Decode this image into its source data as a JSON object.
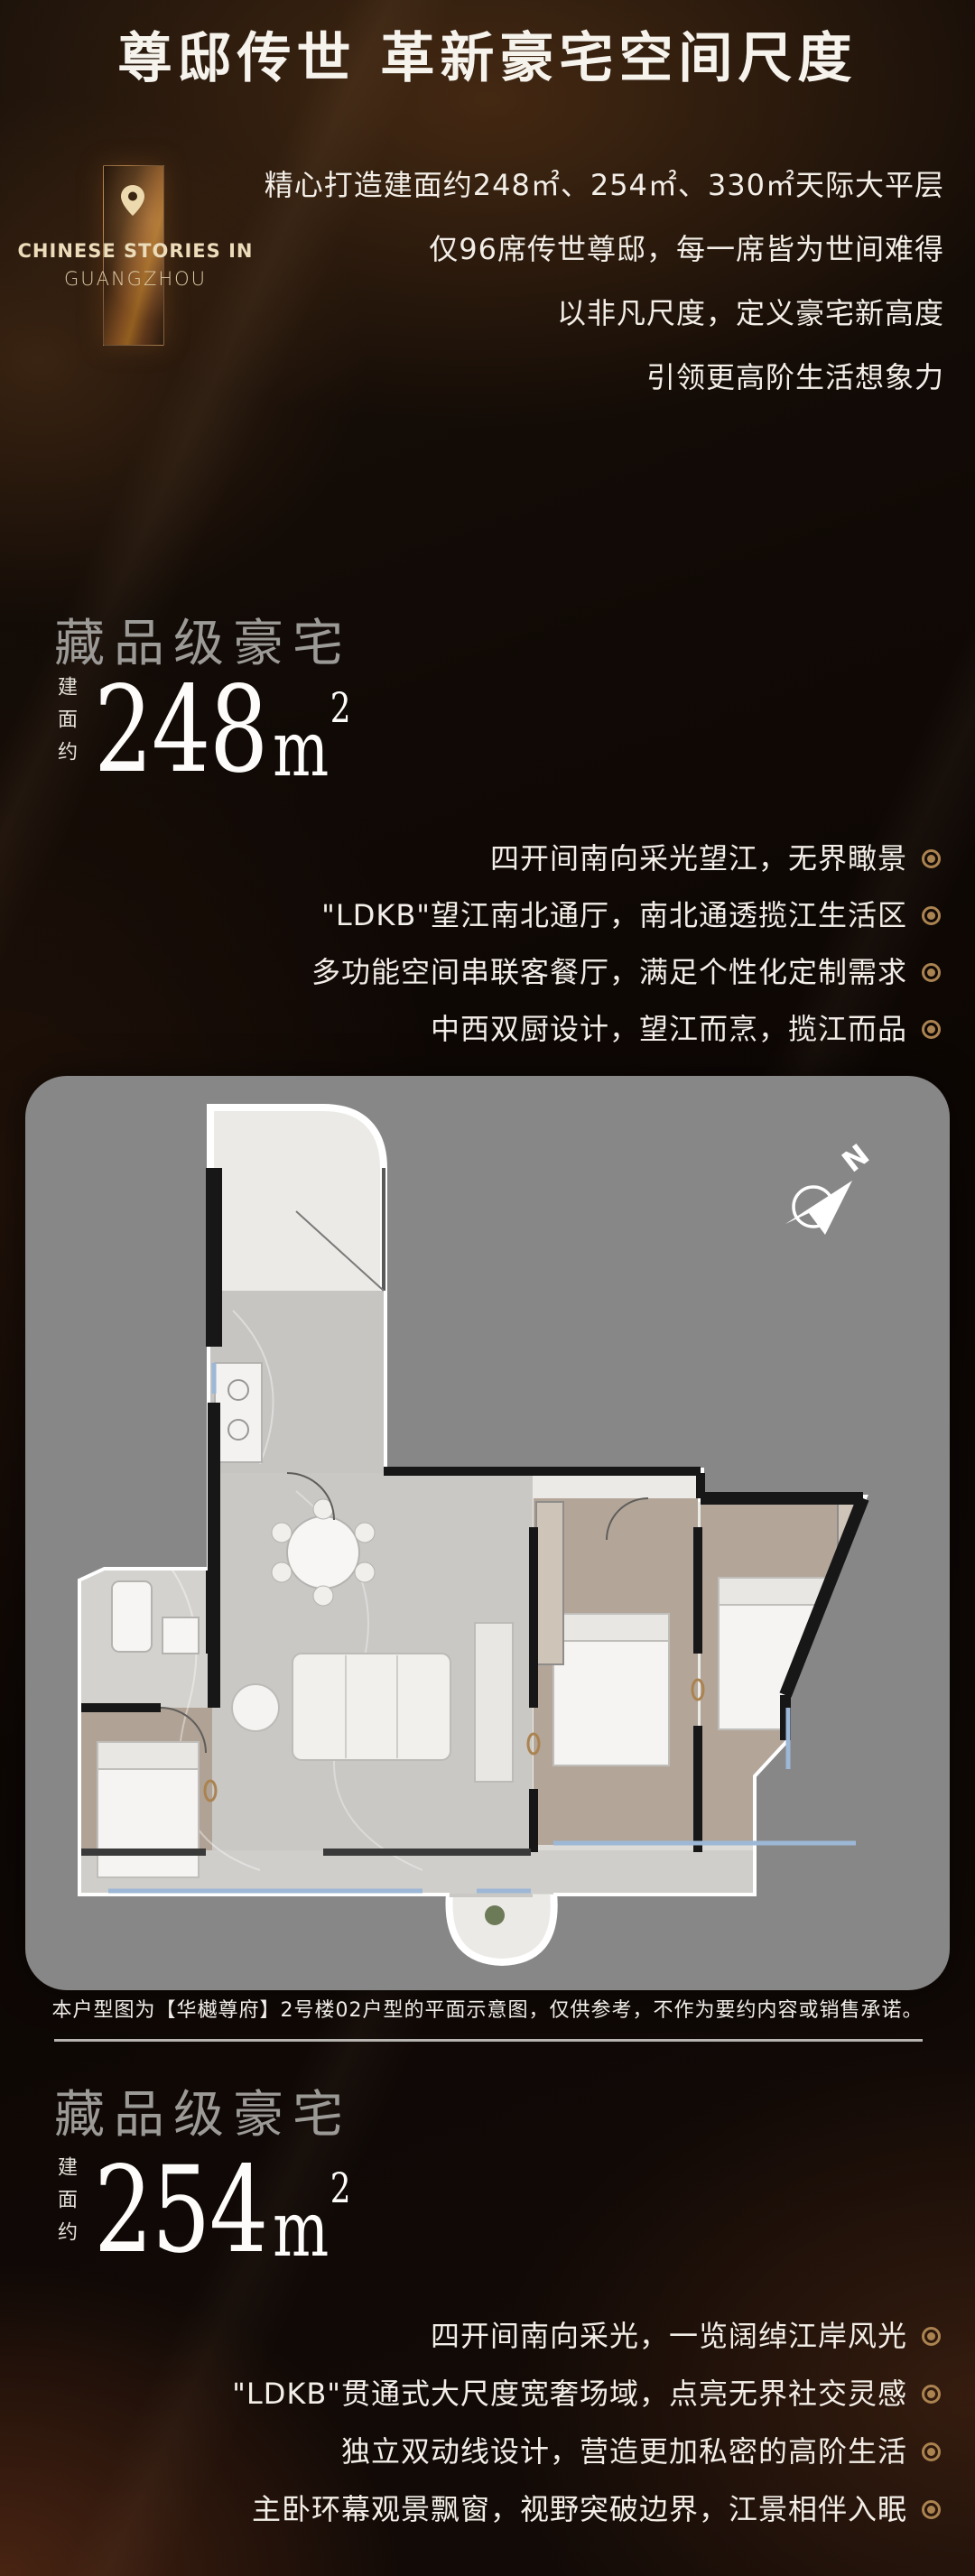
{
  "header": {
    "title": "尊邸传世 革新豪宅空间尺度"
  },
  "badge": {
    "pin_icon": "location-pin",
    "line1": "CHINESE STORIES IN",
    "line2": "GUANGZHOU"
  },
  "intro": {
    "lines": [
      "精心打造建面约248㎡、254㎡、330㎡天际大平层",
      "仅96席传世尊邸，每一席皆为世间难得",
      "以非凡尺度，定义豪宅新高度",
      "引领更高阶生活想象力"
    ]
  },
  "sections": [
    {
      "heading": "藏品级豪宅",
      "area_label": "建面约",
      "area_value": "248",
      "area_unit": "m",
      "area_exp": "2",
      "features": [
        "四开间南向采光望江，无界瞰景",
        "\"LDKB\"望江南北通厅，南北通透揽江生活区",
        "多功能空间串联客餐厅，满足个性化定制需求",
        "中西双厨设计，望江而烹，揽江而品"
      ]
    },
    {
      "heading": "藏品级豪宅",
      "area_label": "建面约",
      "area_value": "254",
      "area_unit": "m",
      "area_exp": "2",
      "features": [
        "四开间南向采光，一览阔绰江岸风光",
        "\"LDKB\"贯通式大尺度宽奢场域，点亮无界社交灵感",
        "独立双动线设计，营造更加私密的高阶生活",
        "主卧环幕观景飘窗，视野突破边界，江景相伴入眠"
      ]
    }
  ],
  "floorplan": {
    "compass_label": "N",
    "compass_icon": "compass-north-arrow",
    "caption": "本户型图为【华樾尊府】2号楼02户型的平面示意图，仅供参考，不作为要约内容或销售承诺。"
  },
  "icons": {
    "feature_bullet": "target-ring"
  },
  "colors": {
    "accent_gold": "#ab8350",
    "card_bg": "#878787",
    "heading_gray": "#9c9a97",
    "text_cream": "#ecdcba",
    "background": "#0f0905"
  }
}
